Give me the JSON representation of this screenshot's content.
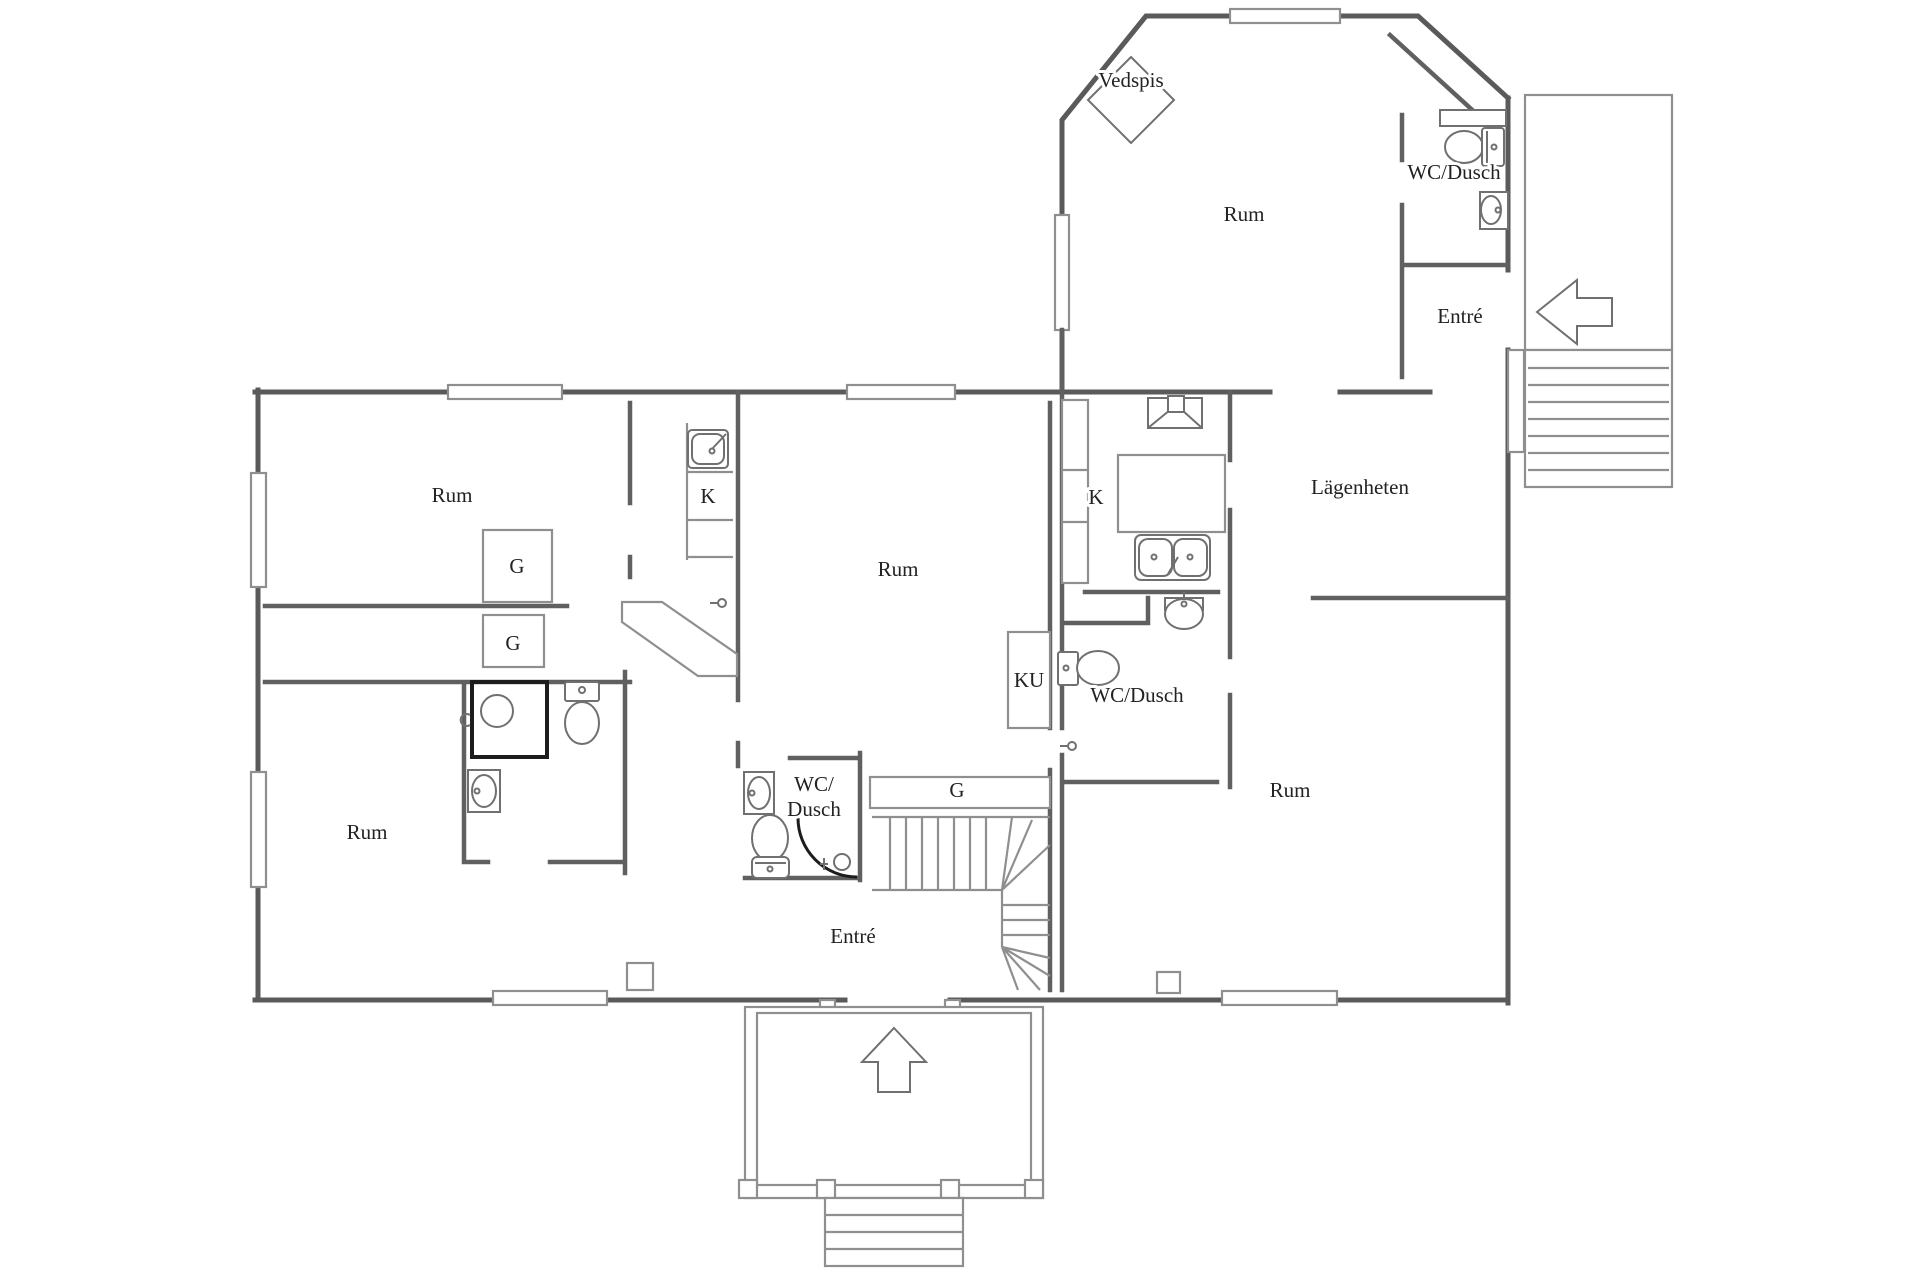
{
  "plan": {
    "type": "floor-plan",
    "language": "Swedish",
    "colors": {
      "background": "#ffffff",
      "wall": "#5a5a5a",
      "thin_line": "#8f8f8f",
      "fixture_line": "#707070",
      "accent": "#1c1c1c",
      "text": "#222222"
    },
    "labels": {
      "vedspis": "Vedspis",
      "rum_octagon": "Rum",
      "wc_dusch_top": "WC/Dusch",
      "entre_top": "Entré",
      "lagenheten": "Lägenheten",
      "k_right": "K",
      "rum_center": "Rum",
      "k_left": "K",
      "rum_top_left": "Rum",
      "g_1": "G",
      "g_2": "G",
      "rum_bottom_left": "Rum",
      "ku": "KU",
      "wc_dusch_right": "WC/Dusch",
      "wc_central_line1": "WC/",
      "wc_central_line2": "Dusch",
      "g_stairs": "G",
      "entre_main": "Entré",
      "rum_bottom_right": "Rum"
    },
    "icons": {
      "vedspis-icon": "diamond wood stove",
      "toilet-icon": "toilet (4 instances)",
      "sink-icon": "washbasin (6 instances)",
      "shower-icon": "shower square",
      "stove-icon": "stove with hood",
      "kitchen-double-sink-icon": "double sink",
      "stairs-icon": "staircase with winders",
      "deck-stairs-icon": "exterior steps right",
      "porch-steps-icon": "entrance steps bottom",
      "arrow-left-icon": "entrance arrow (right deck)",
      "arrow-up-icon": "entrance arrow (bottom porch)",
      "door-arc-icon": "door swing arc",
      "floor-drain-icon": "floor drain"
    }
  }
}
